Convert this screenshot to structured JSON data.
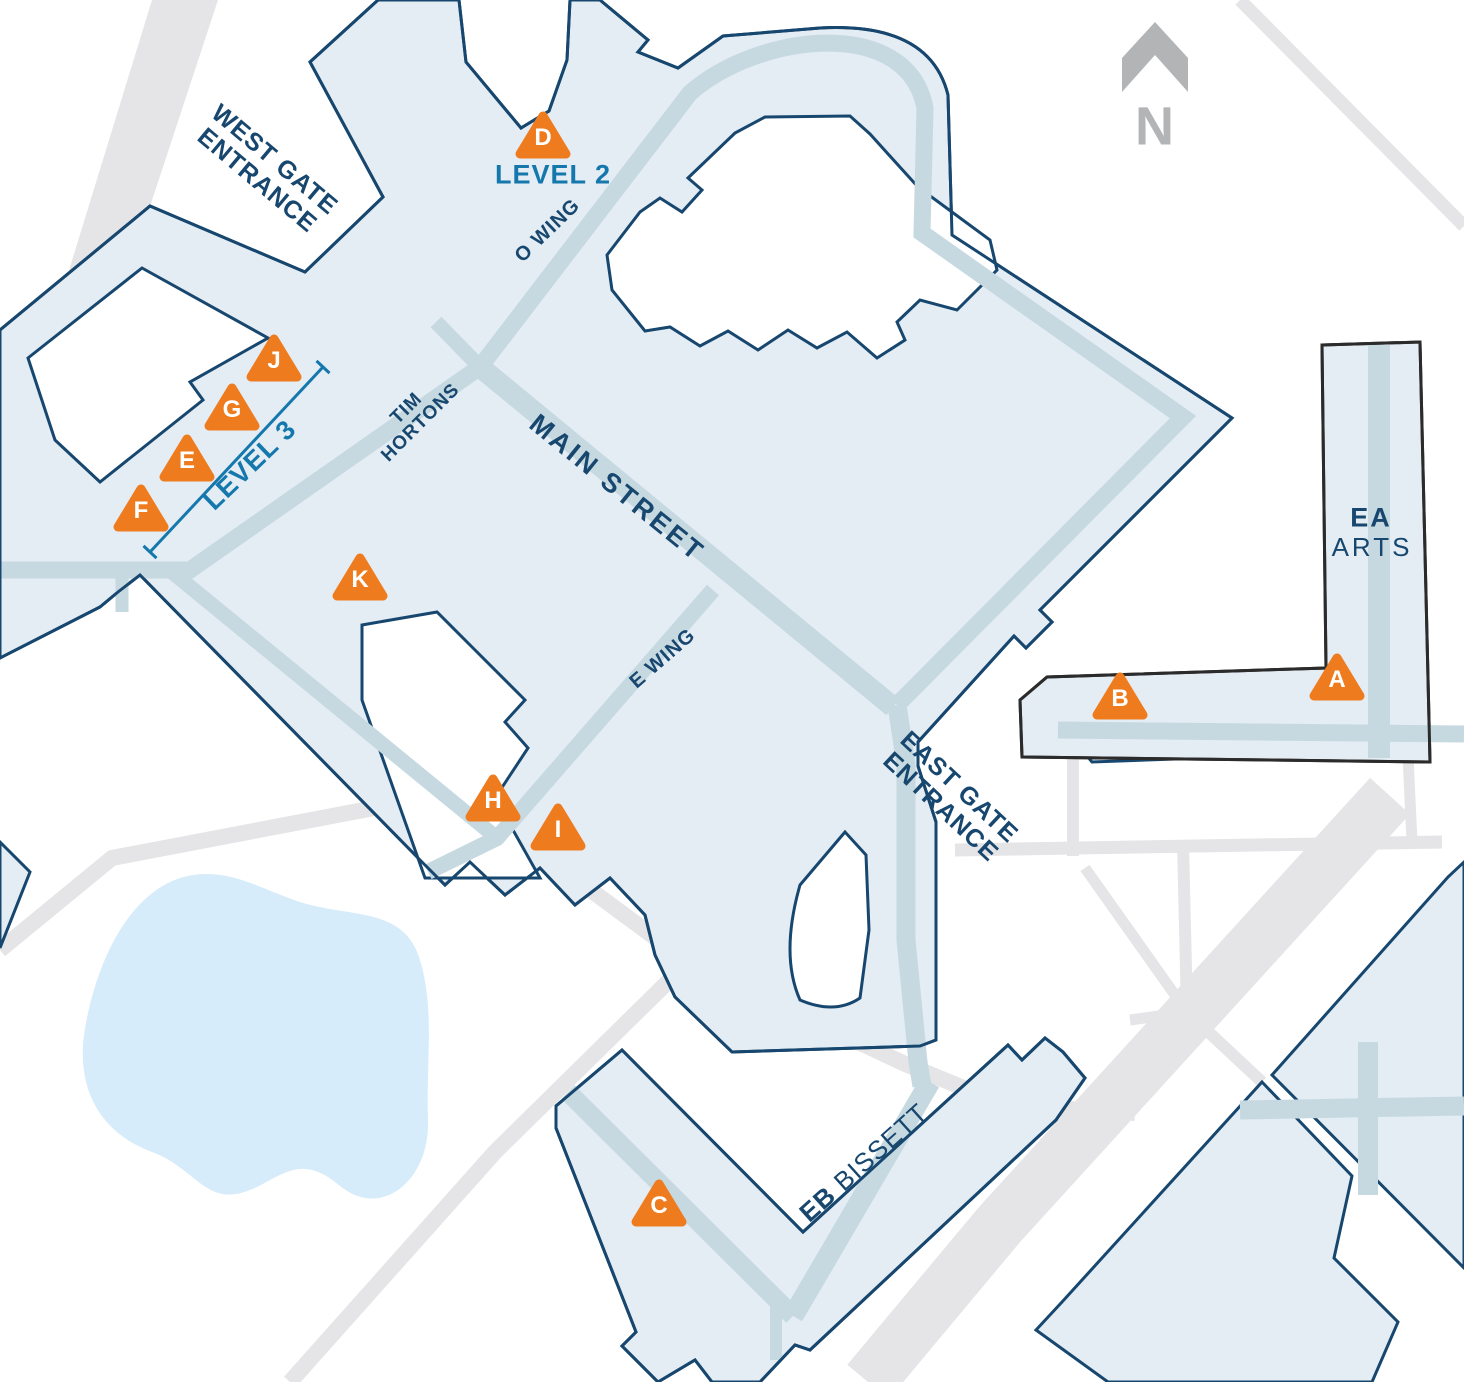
{
  "colors": {
    "background": "#ffffff",
    "building_fill": "#e4ecf4",
    "building_outline": "#17476e",
    "ea_building_outline": "#2b2b2b",
    "corridor": "#c6d9e1",
    "road": "#e5e5e7",
    "pond": "#d7ecfa",
    "marker_orange": "#ee7c1f",
    "label_navy": "#17476e",
    "label_blue": "#1478ad",
    "north_gray": "#b2b4b6"
  },
  "north_indicator": {
    "label": "N"
  },
  "labels": [
    {
      "id": "west-gate-entrance",
      "text": "WEST GATE\nENTRANCE",
      "x": 266,
      "y": 170,
      "rot": 40,
      "size": 25
    },
    {
      "id": "level-2",
      "text": "LEVEL 2",
      "x": 553,
      "y": 175,
      "rot": 0,
      "size": 27,
      "color": "blue"
    },
    {
      "id": "o-wing",
      "text": "O WING",
      "x": 548,
      "y": 231,
      "rot": -44,
      "size": 20
    },
    {
      "id": "tim-hortons",
      "text": "TIM\nHORTONS",
      "x": 414,
      "y": 416,
      "rot": -45,
      "size": 19
    },
    {
      "id": "level-3",
      "text": "LEVEL 3",
      "x": 250,
      "y": 465,
      "rot": -44,
      "size": 27,
      "color": "blue"
    },
    {
      "id": "main-street",
      "text": "MAIN STREET",
      "x": 617,
      "y": 488,
      "rot": 39,
      "size": 27,
      "spacing": 3
    },
    {
      "id": "e-wing",
      "text": "E WING",
      "x": 663,
      "y": 659,
      "rot": -41,
      "size": 20
    },
    {
      "id": "east-gate-entrance",
      "text": "EAST GATE\nENTRANCE",
      "x": 950,
      "y": 797,
      "rot": 43,
      "size": 25
    },
    {
      "id": "ea",
      "text": "EA",
      "x": 1371,
      "y": 518,
      "rot": 0,
      "size": 27,
      "spacing": 2
    },
    {
      "id": "arts",
      "text": "ARTS",
      "x": 1372,
      "y": 548,
      "rot": 0,
      "size": 26,
      "weight": 400,
      "spacing": 3
    },
    {
      "id": "eb-bissett",
      "bold": "EB",
      "text": " BISSETT",
      "x": 864,
      "y": 1163,
      "rot": -42,
      "size": 26
    },
    {
      "id": "north-n",
      "text": "N",
      "x": 1155,
      "y": 127,
      "rot": 0,
      "size": 54,
      "color": "gray"
    }
  ],
  "markers": {
    "items": [
      {
        "letter": "A",
        "x": 1337,
        "y": 677
      },
      {
        "letter": "B",
        "x": 1120,
        "y": 696
      },
      {
        "letter": "C",
        "x": 659,
        "y": 1203
      },
      {
        "letter": "D",
        "x": 543,
        "y": 135
      },
      {
        "letter": "E",
        "x": 187,
        "y": 458
      },
      {
        "letter": "F",
        "x": 141,
        "y": 508
      },
      {
        "letter": "G",
        "x": 232,
        "y": 407
      },
      {
        "letter": "H",
        "x": 493,
        "y": 798
      },
      {
        "letter": "I",
        "x": 558,
        "y": 827
      },
      {
        "letter": "J",
        "x": 274,
        "y": 358
      },
      {
        "letter": "K",
        "x": 360,
        "y": 577
      }
    ]
  }
}
